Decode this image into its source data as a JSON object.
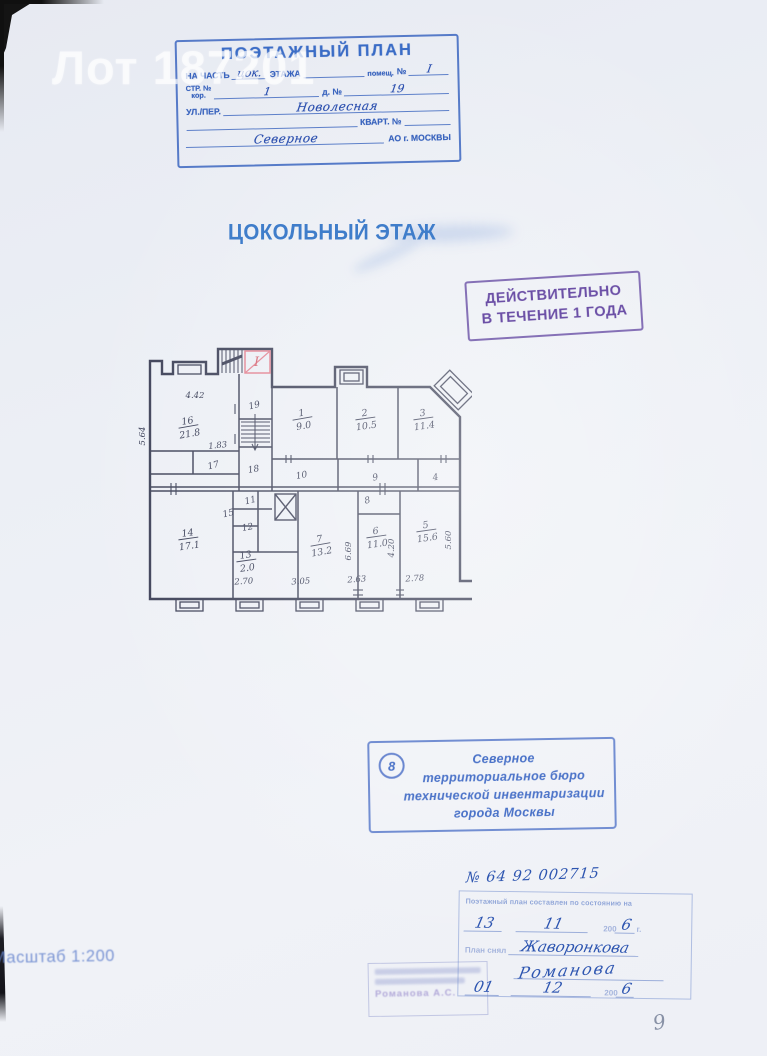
{
  "watermark": "Лот 187201",
  "header_stamp": {
    "title": "ПОЭТАЖНЫЙ ПЛАН",
    "row2": {
      "l1": "НА ЧАСТЬ",
      "hand1": "цок.",
      "l2": "ЭТАЖА",
      "l3": "помещ.",
      "l4": "№",
      "hand2": "I"
    },
    "row3": {
      "l1": "СТР. №",
      "sub": "кор.",
      "hand1": "1",
      "l2": "д. №",
      "hand2": "19"
    },
    "row4": {
      "l1": "УЛ./ПЕР.",
      "hand": "Новолесная"
    },
    "row5": {
      "l1": "КВАРТ. №"
    },
    "row6": {
      "hand": "Северное",
      "l1": "АО г. МОСКВЫ"
    }
  },
  "floor_title": "ЦОКОЛЬНЫЙ ЭТАЖ",
  "validity_stamp": {
    "line1": "ДЕЙСТВИТЕЛЬНО",
    "line2": "В ТЕЧЕНИЕ 1 ГОДА"
  },
  "plan": {
    "entrance_mark": "I",
    "room_labels": [
      {
        "num": "16",
        "area": "21.8",
        "x": 50,
        "y": 80,
        "rot": -10
      },
      {
        "num": "17",
        "x": 76,
        "y": 124,
        "rot": -14
      },
      {
        "num": "19",
        "x": 117,
        "y": 64,
        "rot": -14
      },
      {
        "num": "18",
        "x": 116,
        "y": 128,
        "rot": -10
      },
      {
        "num": "1",
        "area": "9.0",
        "x": 164,
        "y": 72,
        "rot": -10
      },
      {
        "num": "2",
        "area": "10.5",
        "x": 227,
        "y": 72,
        "rot": -8
      },
      {
        "num": "3",
        "area": "11.4",
        "x": 285,
        "y": 72,
        "rot": -8
      },
      {
        "num": "10",
        "x": 164,
        "y": 134,
        "rot": -10
      },
      {
        "num": "9",
        "x": 238,
        "y": 136,
        "rot": -14
      },
      {
        "num": "4",
        "x": 298,
        "y": 136,
        "rot": -10
      },
      {
        "num": "14",
        "area": "17.1",
        "x": 50,
        "y": 192,
        "rot": -8
      },
      {
        "num": "15",
        "x": 91,
        "y": 172,
        "rot": -14
      },
      {
        "num": "11",
        "x": 113,
        "y": 159,
        "rot": -14
      },
      {
        "num": "12",
        "x": 110,
        "y": 186,
        "rot": -10
      },
      {
        "num": "13",
        "area": "2.0",
        "x": 108,
        "y": 214,
        "rot": -8
      },
      {
        "num": "7",
        "area": "13.2",
        "x": 182,
        "y": 198,
        "rot": -10
      },
      {
        "num": "8",
        "x": 230,
        "y": 159,
        "rot": -14
      },
      {
        "num": "6",
        "area": "11.0",
        "x": 238,
        "y": 190,
        "rot": -8
      },
      {
        "num": "5",
        "area": "15.6",
        "x": 288,
        "y": 184,
        "rot": -8
      }
    ],
    "dimensions": [
      {
        "text": "4.42",
        "x": 57,
        "y": 54
      },
      {
        "text": "5.64",
        "x": 7,
        "y": 92,
        "rot": -90
      },
      {
        "text": "1.83",
        "x": 80,
        "y": 104,
        "rot": -6
      },
      {
        "text": "2.70",
        "x": 106,
        "y": 240,
        "rot": -4
      },
      {
        "text": "3.05",
        "x": 163,
        "y": 240,
        "rot": -4
      },
      {
        "text": "2.63",
        "x": 219,
        "y": 238,
        "rot": -4
      },
      {
        "text": "2.78",
        "x": 277,
        "y": 237,
        "rot": -4
      },
      {
        "text": "6.69",
        "x": 213,
        "y": 207,
        "rot": -90
      },
      {
        "text": "4.20",
        "x": 256,
        "y": 204,
        "rot": -90
      },
      {
        "text": "5.60",
        "x": 313,
        "y": 196,
        "rot": -90
      }
    ]
  },
  "bureau_stamp": {
    "number": "8",
    "lines": [
      "Северное",
      "территориальное бюро",
      "технической инвентаризации",
      "города Москвы"
    ]
  },
  "inventory_number": "№ 64 92 002715",
  "date_stamp": {
    "header": "Поэтажный план составлен по состоянию на",
    "day": "13",
    "month": "11",
    "year_prefix": "200",
    "year": "6",
    "year_suffix": "г.",
    "taken_label": "План снял",
    "surveyor": "Жаворонкова",
    "signature": "Романова",
    "day2": "01",
    "month2": "12",
    "year2": "6"
  },
  "checker_stamp": {
    "name": "Романова А.С."
  },
  "scale": "Масштаб 1:200",
  "page_number": "9"
}
